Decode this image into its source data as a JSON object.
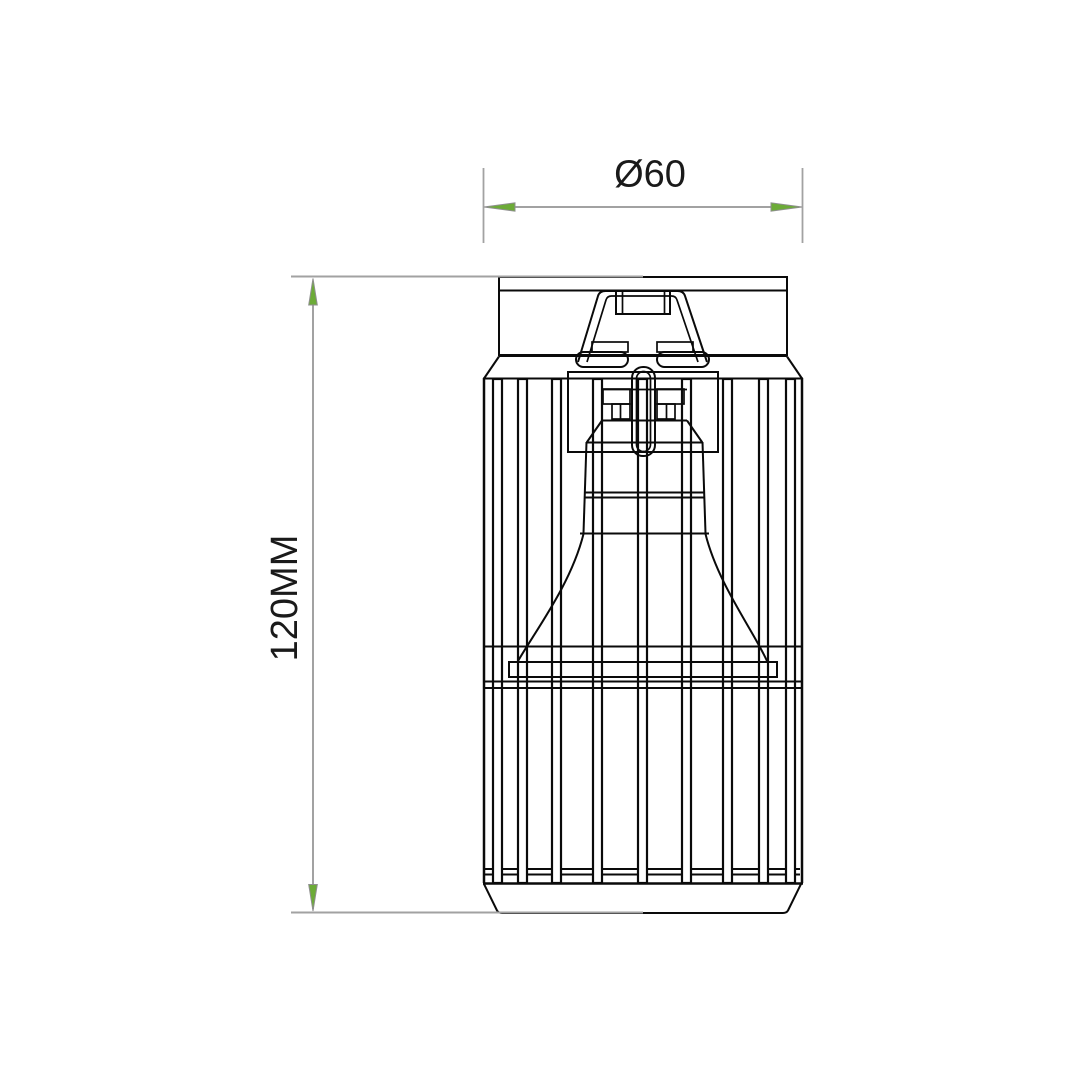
{
  "page": {
    "background_color": "#ffffff"
  },
  "drawing": {
    "subject": "cage spotlight ceiling fixture front elevation",
    "line_color": "#0a0a0a"
  },
  "dimensions": {
    "diameter": {
      "label": "Ø60"
    },
    "height": {
      "label": "120MM"
    },
    "style": {
      "line_color": "#a2a2a2",
      "arrow_fill": "#6cab37",
      "arrow_outline": "#8f8f8f",
      "text_color": "#1a1a1a"
    }
  }
}
